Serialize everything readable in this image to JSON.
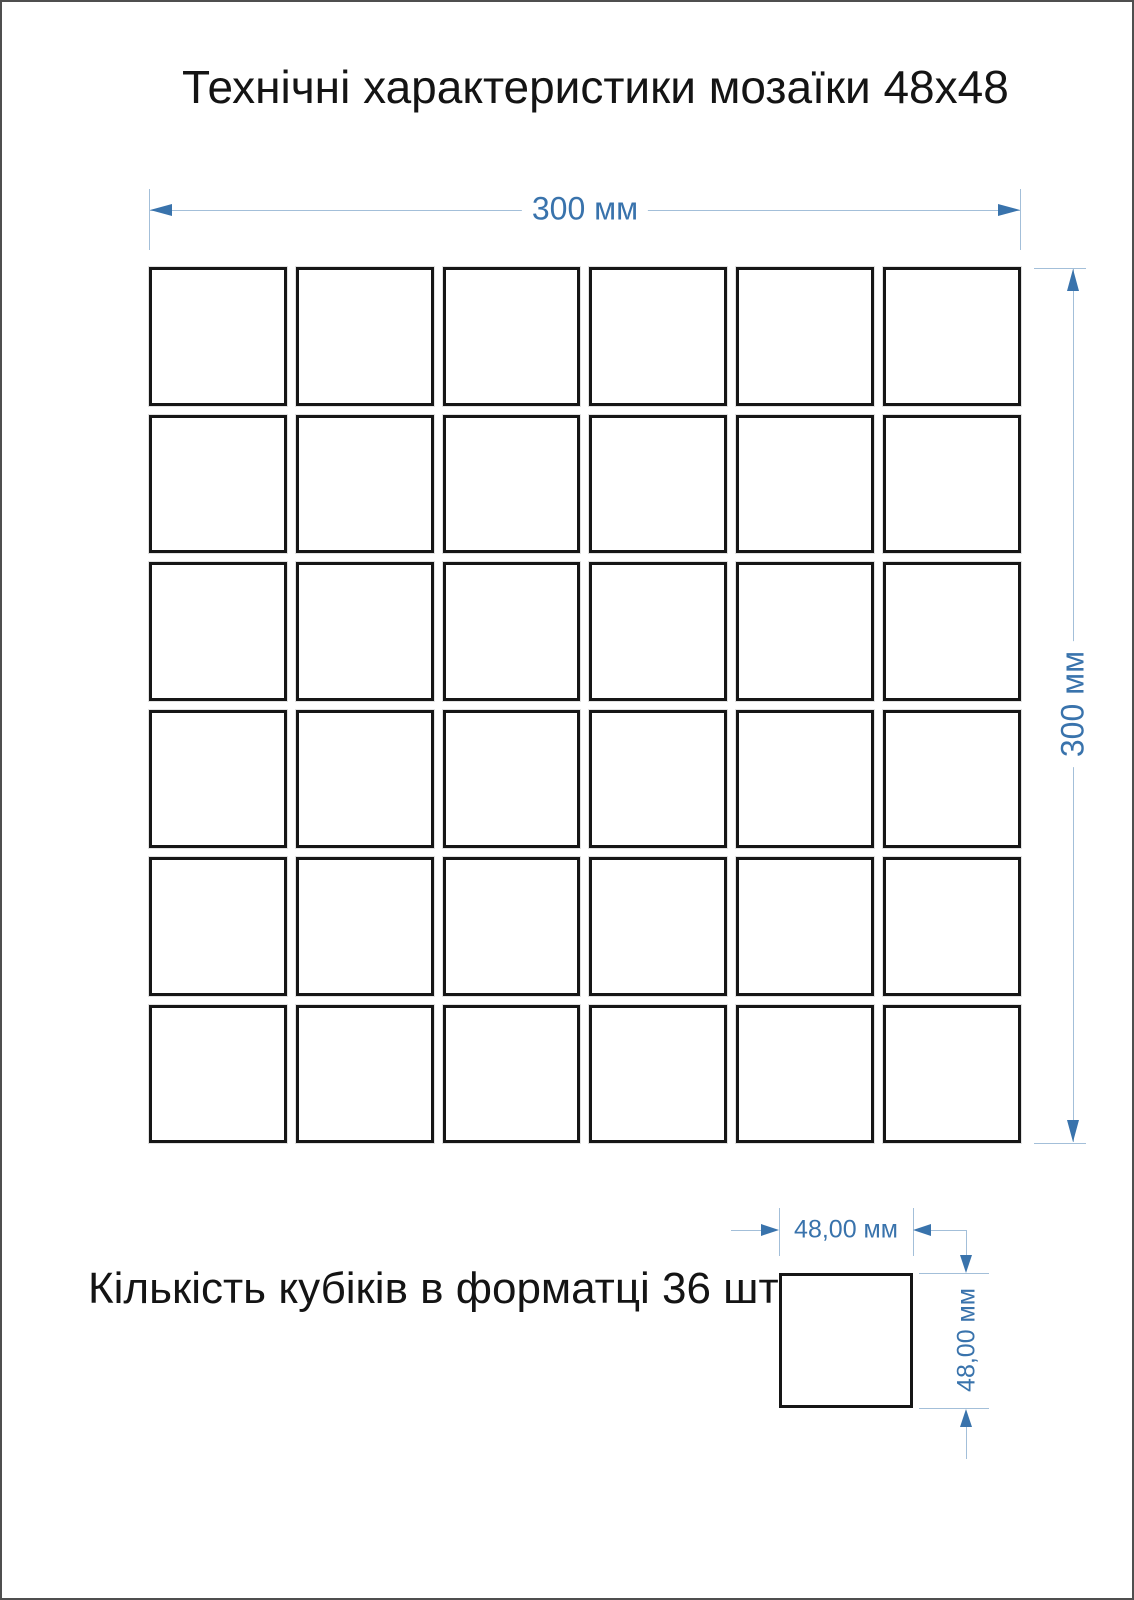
{
  "page": {
    "title": "Технічні характеристики мозаїки 48х48",
    "caption": "Кількість кубіків в форматці 36 шт"
  },
  "dimensions": {
    "sheet_width": "300 мм",
    "sheet_height": "300 мм",
    "chip_width": "48,00 мм",
    "chip_height": "48,00 мм"
  },
  "grid": {
    "rows": 6,
    "cols": 6,
    "tile_count": 36
  },
  "colors": {
    "dimension_accent": "#3973AC",
    "dimension_line": "#A3BFD9",
    "tile_border": "#161616",
    "page_border": "#4F4F4F"
  }
}
